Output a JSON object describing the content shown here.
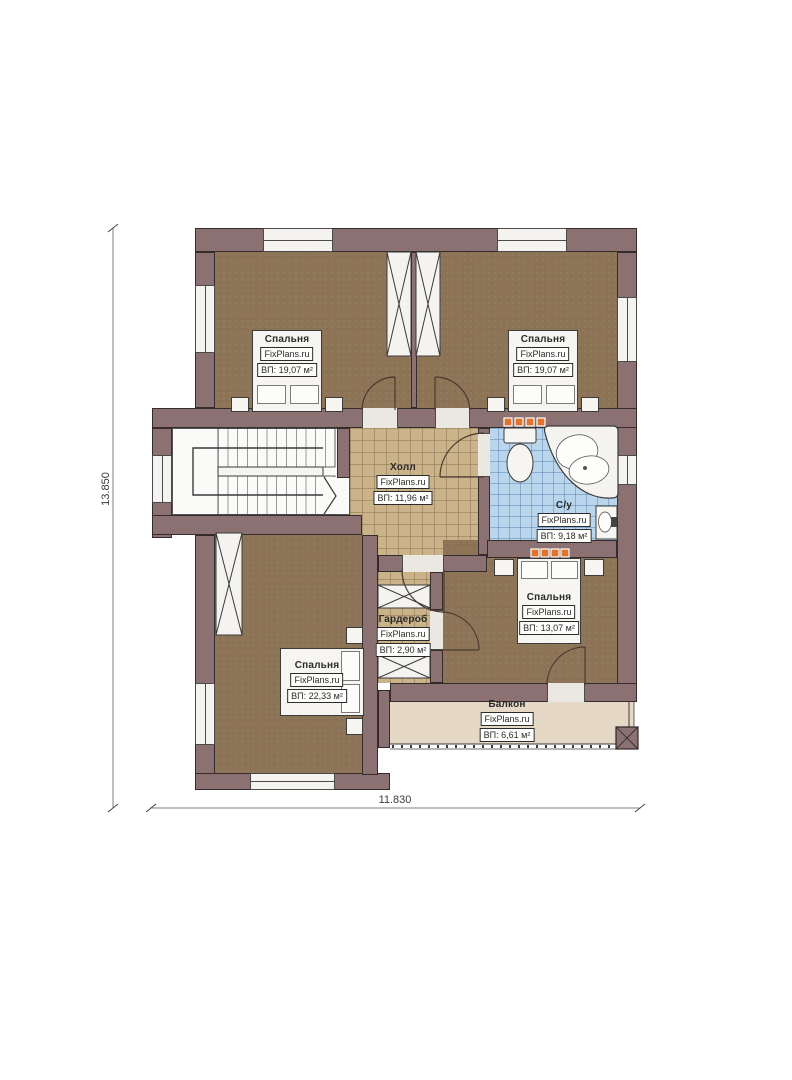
{
  "drawing": {
    "type": "floor-plan",
    "floor": "second-floor"
  },
  "dimensions": {
    "height_label": "13.850",
    "width_label": "11.830"
  },
  "brand": "FixPlans.ru",
  "rooms": [
    {
      "id": "bedroom-top-left",
      "name": "Спальня",
      "brand": "FixPlans.ru",
      "area": "ВП: 19,07 м²"
    },
    {
      "id": "bedroom-top-right",
      "name": "Спальня",
      "brand": "FixPlans.ru",
      "area": "ВП: 19,07 м²"
    },
    {
      "id": "hall",
      "name": "Холл",
      "brand": "FixPlans.ru",
      "area": "ВП: 11,96 м²"
    },
    {
      "id": "bathroom",
      "name": "С/у",
      "brand": "FixPlans.ru",
      "area": "ВП: 9,18 м²"
    },
    {
      "id": "wardrobe",
      "name": "Гардероб",
      "brand": "FixPlans.ru",
      "area": "ВП: 2,90 м²"
    },
    {
      "id": "bedroom-bottom-left",
      "name": "Спальня",
      "brand": "FixPlans.ru",
      "area": "ВП: 22,33 м²"
    },
    {
      "id": "bedroom-bottom-right",
      "name": "Спальня",
      "brand": "FixPlans.ru",
      "area": "ВП: 13,07 м²"
    },
    {
      "id": "balcony",
      "name": "Балкон",
      "brand": "FixPlans.ru",
      "area": "ВП: 6,61 м²"
    }
  ],
  "palette": {
    "wall": "#8b7172",
    "bedroom_floor": "#8d7456",
    "hall_floor": "#cab289",
    "bathroom_floor": "#b9d6ec",
    "balcony_floor": "#e5d9c5",
    "radiator": "#e0732d",
    "line": "#3b3b3b"
  }
}
